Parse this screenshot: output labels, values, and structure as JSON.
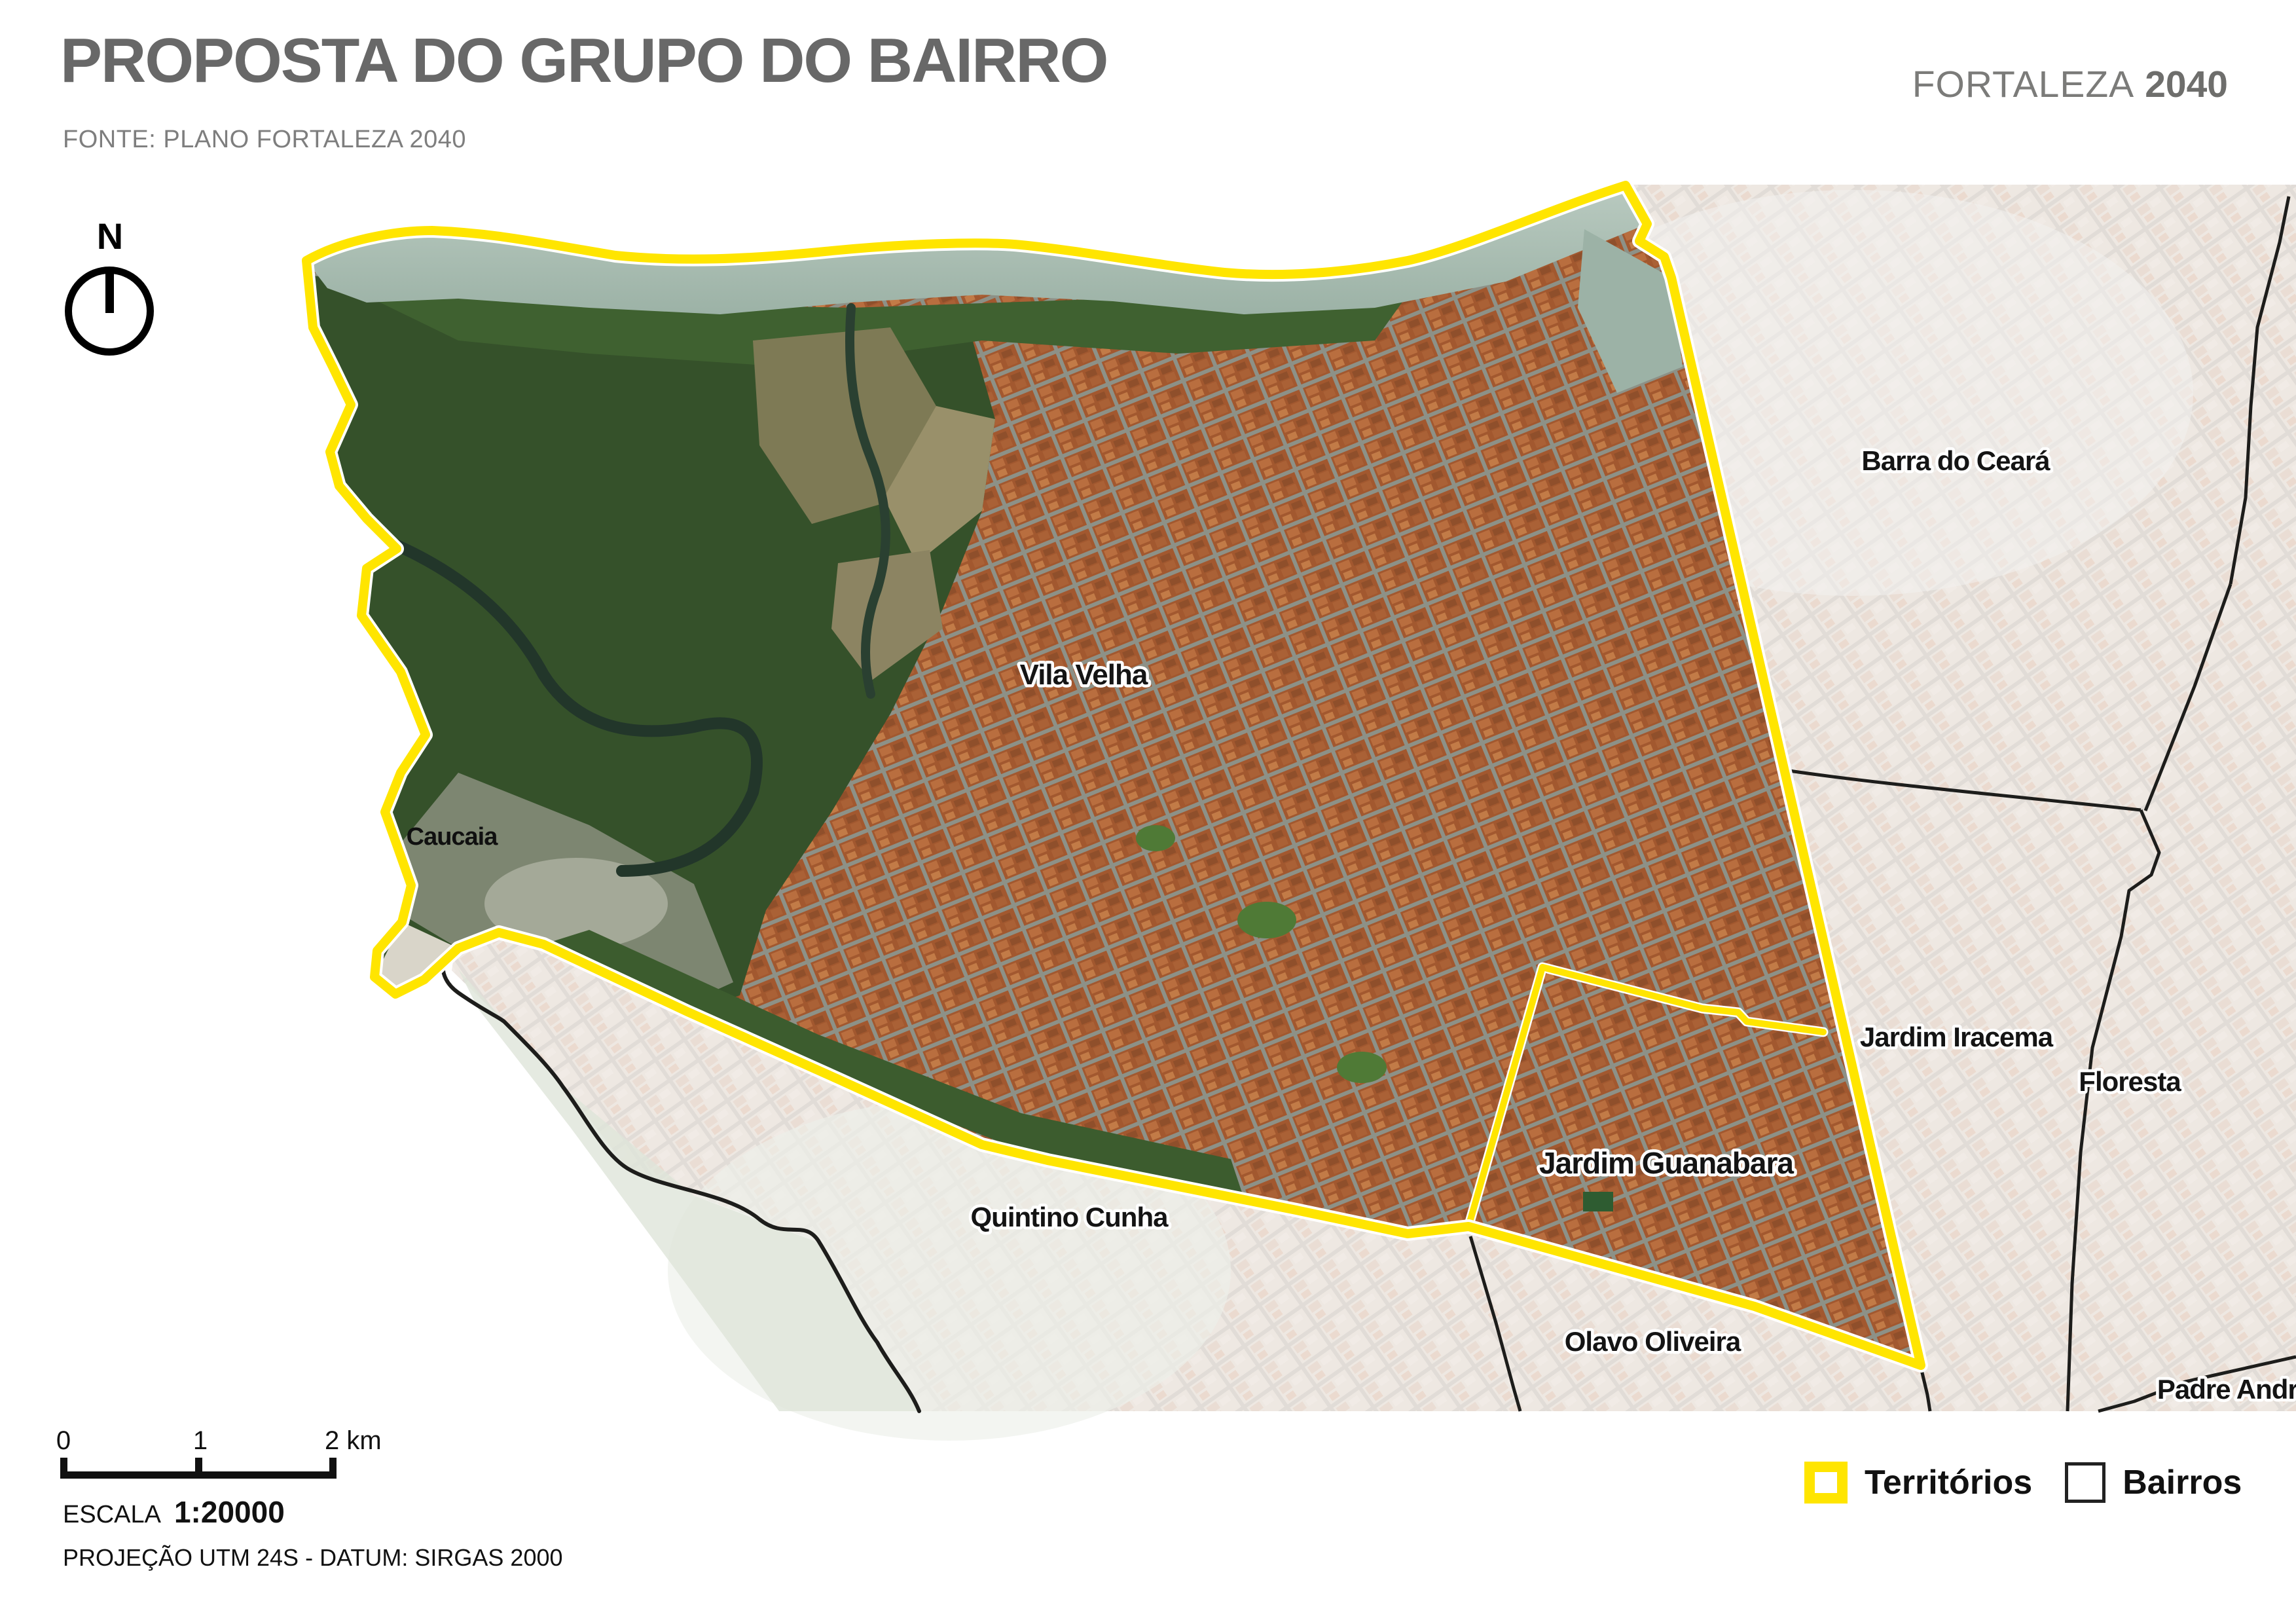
{
  "header": {
    "title": "PROPOSTA DO GRUPO DO BAIRRO",
    "source": "FONTE: PLANO FORTALEZA 2040",
    "brand_name": "FORTALEZA",
    "brand_year": "2040"
  },
  "north_indicator": {
    "label": "N"
  },
  "map": {
    "labels": {
      "vila_velha": "Vila Velha",
      "caucaia": "Caucaia",
      "barra_do_ceara": "Barra do Ceará",
      "jardim_iracema": "Jardim Iracema",
      "floresta": "Floresta",
      "jardim_guanabara": "Jardim Guanabara",
      "quintino_cunha": "Quintino Cunha",
      "olavo_oliveira": "Olavo Oliveira",
      "padre_andrade": "Padre Andrade"
    },
    "colors": {
      "territory_outline": "#ffe500",
      "territory_casing": "#ffffff",
      "bairro_outline": "#1d1d1b",
      "title_gray": "#686868",
      "brand_gray": "#7b7b79"
    }
  },
  "scale_bar": {
    "tick0": "0",
    "tick1": "1",
    "tick2": "2 km",
    "escala_label": "ESCALA",
    "escala_value": "1:20000",
    "projection": "PROJEÇÃO UTM 24S - DATUM: SIRGAS 2000"
  },
  "legend": {
    "territorios_label": "Territórios",
    "bairros_label": "Bairros"
  }
}
